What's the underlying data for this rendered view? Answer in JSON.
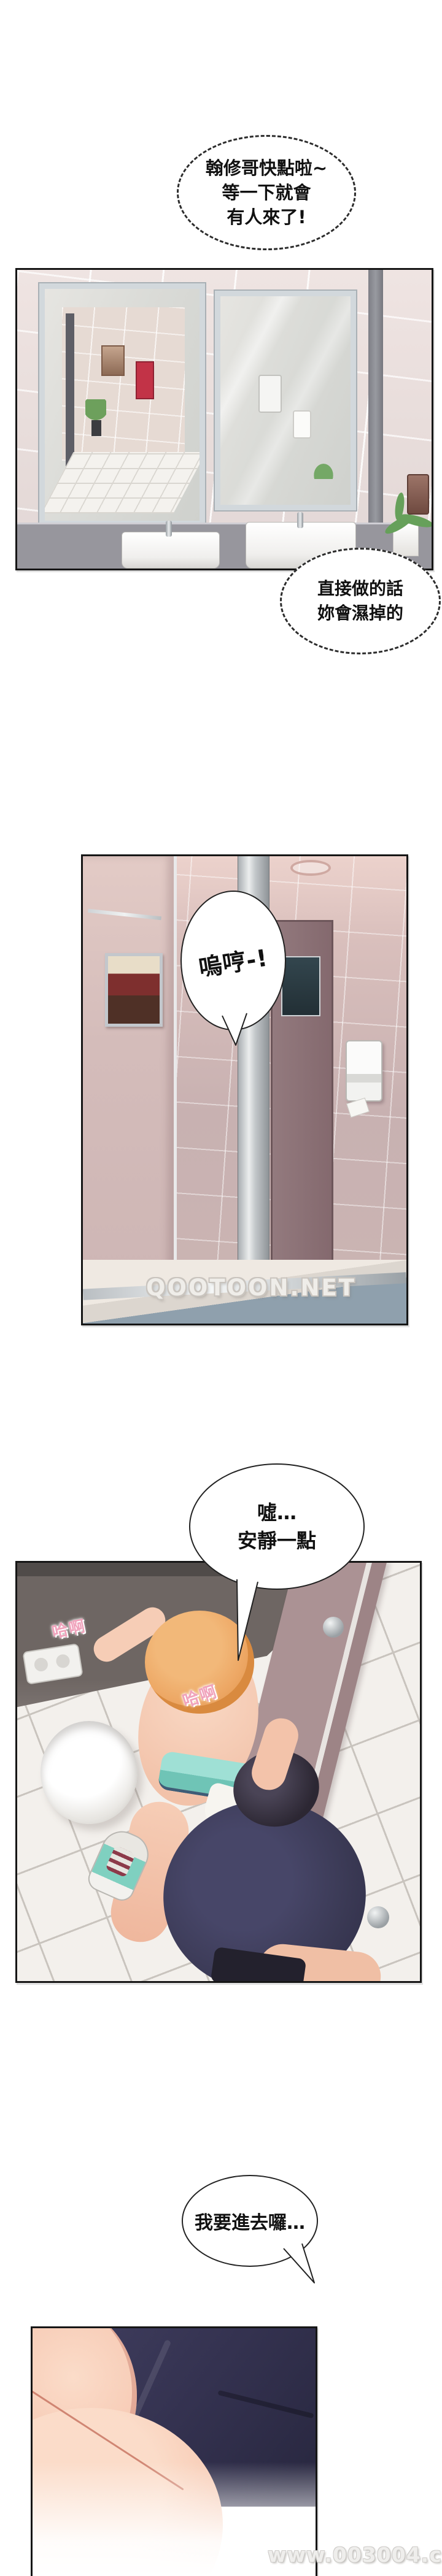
{
  "page": {
    "kind": "webtoon-comic-page",
    "background": "#ffffff"
  },
  "bubbles": {
    "b1": {
      "style": "dashed-ellipse",
      "lines": [
        "翰修哥快點啦~",
        "等一下就會",
        "有人來了!"
      ]
    },
    "b2": {
      "style": "dashed-ellipse",
      "lines": [
        "直接做的話",
        "妳會濕掉的"
      ]
    },
    "b3": {
      "style": "solid-ellipse-handwritten",
      "lines": [
        "嗚哼-!"
      ]
    },
    "b4": {
      "style": "solid-ellipse",
      "lines": [
        "噓…",
        "安靜一點"
      ]
    },
    "b5": {
      "style": "solid-ellipse",
      "lines": [
        "我要進去囉…"
      ]
    }
  },
  "sfx": {
    "s1": {
      "text": "哈啊",
      "color": "#f0a3bc"
    },
    "s2": {
      "text": "哈啊",
      "color": "#f0a3bc"
    }
  },
  "watermarks": {
    "w1": {
      "text": "QOOTOON.NET"
    },
    "w2": {
      "text": "www.003004.com"
    }
  },
  "panels": {
    "p1": {
      "alt": "public restroom wall with two steel-framed mirrors, grey counter, two white sinks, small plant, paper-towel dispenser"
    },
    "p2": {
      "alt": "mauve-tiled restroom corridor with stall partitions, mirror strip, framed picture reflection, white soap dispenser"
    },
    "p3": {
      "alt": "top-down view of two figures in a restroom stall beside a white bin; abstracted shapes"
    },
    "p4": {
      "alt": "close-up abstract detail of navy fabric and skin tones fading to white"
    }
  },
  "colors": {
    "panel_border": "#161616",
    "p1_tile": "#e9dedb",
    "p1_counter": "#97969d",
    "p2_tile": "#c8b1b1",
    "p3_wall_dark": "#6e6663",
    "p3_wall_mauve": "#a78f90",
    "hair_blonde": "#eda764",
    "hair_dark": "#2c2733",
    "top_teal": "#8fd8cc",
    "shirt_navy": "#3a3954",
    "skin": "#f6cdb6"
  }
}
